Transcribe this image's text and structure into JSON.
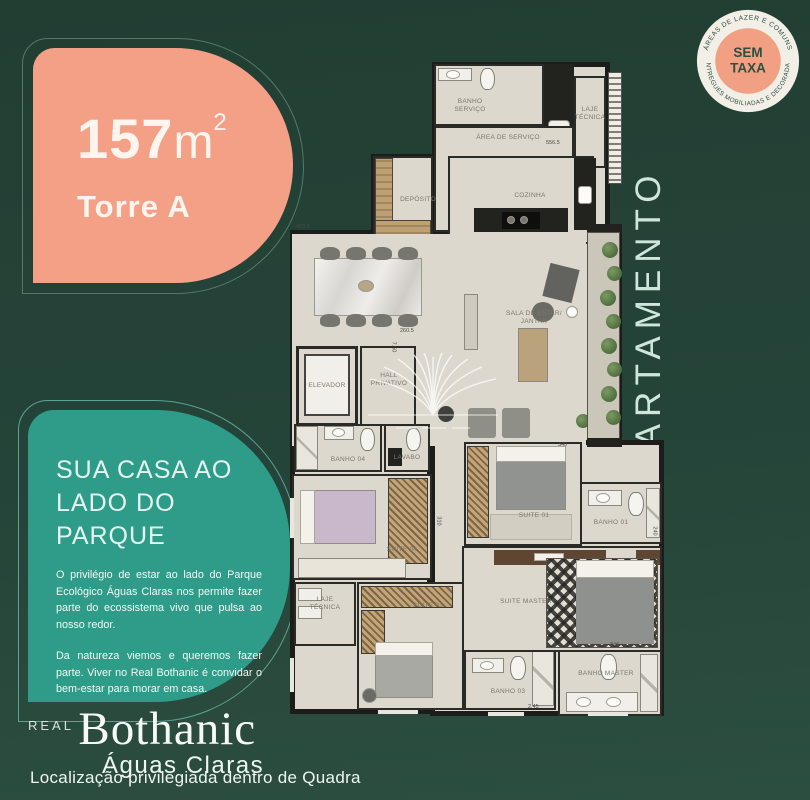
{
  "colors": {
    "background_green": "#24433A",
    "card_salmon": "#F4A086",
    "card_teal": "#2F9C8A",
    "badge_ring": "#F2EFE7",
    "badge_center": "#F1A083",
    "badge_text": "#2E4F40",
    "plan_floor": "#DDD8CE",
    "plan_wall": "#1C1C1A",
    "accent_text": "#CFE6DC"
  },
  "area_card": {
    "value": "157",
    "unit": "m",
    "sup": "2",
    "tower": "Torre A"
  },
  "badge": {
    "line1": "SEM",
    "line2": "TAXA",
    "arc_top": "ÁREAS DE LAZER E COMUNS",
    "arc_bottom": "ENTREGUES MOBILIADAS E DECORADAS"
  },
  "side_label": {
    "text": "APARTAMENTO"
  },
  "info_card": {
    "title": "SUA CASA AO LADO DO PARQUE",
    "para1": "O privilégio de estar ao lado do Parque Ecológico Águas Claras nos permite fazer parte do ecossistema vivo que pulsa ao nosso redor.",
    "para2": "Da natureza viemos e queremos fazer parte. Viver no Real Bothanic é convidar o bem-estar para morar em casa."
  },
  "brand": {
    "prefix": "REAL",
    "name": "Bothanic",
    "sub": "Águas Claras"
  },
  "footer": {
    "tagline": "Localização privilegiada dentro de Quadra"
  },
  "floorplan": {
    "rooms": [
      {
        "label": "BANHO SERVIÇO"
      },
      {
        "label": "LAJE TÉCNICA"
      },
      {
        "label": "ÁREA DE SERVIÇO"
      },
      {
        "label": "DEPÓSITO"
      },
      {
        "label": "COZINHA"
      },
      {
        "label": "SALA DE ESTAR/ JANTAR"
      },
      {
        "label": "ELEVADOR"
      },
      {
        "label": "HALL PRIVATIVO"
      },
      {
        "label": "BANHO 04"
      },
      {
        "label": "LAVABO"
      },
      {
        "label": "SUITE 04"
      },
      {
        "label": "LAJE TÉCNICA"
      },
      {
        "label": "SUITE 03"
      },
      {
        "label": "BANHO 03"
      },
      {
        "label": "SUITE 01"
      },
      {
        "label": "BANHO 01"
      },
      {
        "label": "SUITE MASTER"
      },
      {
        "label": "BANHO MASTER"
      }
    ],
    "dims": [
      {
        "t": "423.5"
      },
      {
        "t": "556.5"
      },
      {
        "t": "260.5"
      },
      {
        "t": "340"
      },
      {
        "t": "240"
      },
      {
        "t": "310"
      },
      {
        "t": "346"
      },
      {
        "t": "2.45"
      },
      {
        "t": "7.50"
      }
    ]
  }
}
